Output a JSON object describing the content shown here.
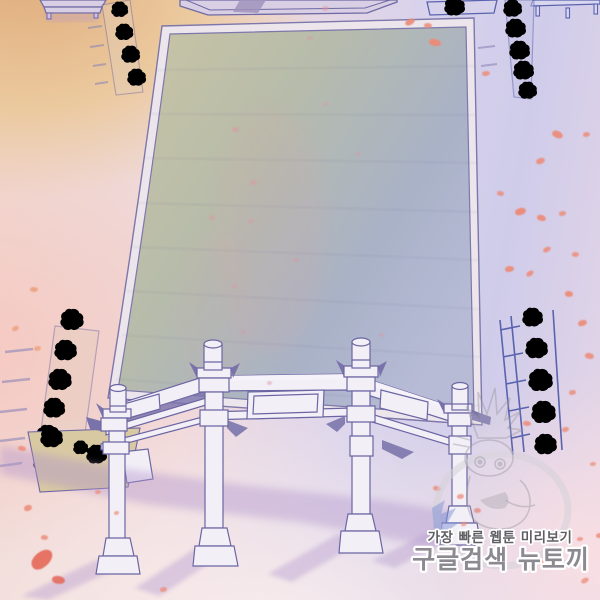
{
  "watermark": {
    "line1": "가장 빠른 웹툰 미리보기",
    "line2": "구글검색 뉴토끼",
    "line1_color": "#5f5e63",
    "line2_color": "#8c8a90",
    "outline_color": "#ffffff"
  },
  "palette": {
    "line": "#6b66a3",
    "salmon": "#ed8a76",
    "orange_petal": "#eb9d72",
    "red": "#e4604f",
    "faint_pink": "#d89aa4",
    "courtyard_khaki": "#cbc5a4",
    "courtyard_blue": "#b7bbd6",
    "ground_orange": "#e0ad7c",
    "ground_pink": "#f6c9c2",
    "ground_lavender": "#cfccea",
    "bush_green": "#a6a98e",
    "bush_blue": "#7f95d6",
    "shadow_purple": "#b094cc"
  },
  "petals": [
    [
      405,
      19,
      10,
      6,
      -20,
      "salmon",
      0.9
    ],
    [
      429,
      39,
      12,
      7,
      18,
      "salmon",
      0.95
    ],
    [
      482,
      71,
      8,
      5,
      0,
      "salmon",
      0.8
    ],
    [
      322,
      6,
      7,
      5,
      0,
      "faint_pink",
      0.55
    ],
    [
      424,
      23,
      8,
      5,
      10,
      "salmon",
      0.85
    ],
    [
      552,
      131,
      11,
      7,
      30,
      "salmon",
      0.9
    ],
    [
      583,
      132,
      7,
      5,
      0,
      "salmon",
      0.8
    ],
    [
      536,
      158,
      9,
      6,
      -15,
      "salmon",
      0.85
    ],
    [
      497,
      191,
      7,
      5,
      20,
      "salmon",
      0.8
    ],
    [
      515,
      208,
      11,
      7,
      -10,
      "salmon",
      0.95
    ],
    [
      537,
      215,
      9,
      6,
      25,
      "salmon",
      0.9
    ],
    [
      559,
      211,
      7,
      5,
      0,
      "salmon",
      0.8
    ],
    [
      543,
      247,
      8,
      5,
      -20,
      "salmon",
      0.85
    ],
    [
      572,
      252,
      7,
      5,
      10,
      "salmon",
      0.8
    ],
    [
      505,
      266,
      9,
      6,
      0,
      "salmon",
      0.9
    ],
    [
      526,
      271,
      8,
      5,
      -25,
      "salmon",
      0.85
    ],
    [
      565,
      291,
      8,
      6,
      15,
      "salmon",
      0.9
    ],
    [
      578,
      320,
      9,
      6,
      -10,
      "salmon",
      0.9
    ],
    [
      585,
      353,
      9,
      6,
      20,
      "salmon",
      0.85
    ],
    [
      569,
      390,
      7,
      5,
      0,
      "salmon",
      0.8
    ],
    [
      523,
      421,
      8,
      5,
      15,
      "salmon",
      0.85
    ],
    [
      562,
      427,
      7,
      5,
      -10,
      "salmon",
      0.8
    ],
    [
      590,
      462,
      6,
      4,
      0,
      "salmon",
      0.7
    ],
    [
      433,
      486,
      8,
      5,
      20,
      "salmon",
      0.8
    ],
    [
      457,
      494,
      7,
      5,
      0,
      "salmon",
      0.75
    ],
    [
      461,
      522,
      6,
      4,
      -15,
      "salmon",
      0.7
    ],
    [
      474,
      508,
      7,
      5,
      10,
      "red",
      0.6
    ],
    [
      540,
      560,
      9,
      6,
      10,
      "salmon",
      0.8
    ],
    [
      577,
      537,
      6,
      4,
      0,
      "salmon",
      0.75
    ],
    [
      596,
      533,
      7,
      5,
      0,
      "salmon",
      0.8
    ],
    [
      581,
      578,
      8,
      5,
      -20,
      "salmon",
      0.75
    ],
    [
      30,
      287,
      8,
      5,
      10,
      "orange_petal",
      0.8
    ],
    [
      12,
      326,
      7,
      5,
      -15,
      "orange_petal",
      0.75
    ],
    [
      34,
      346,
      7,
      5,
      0,
      "orange_petal",
      0.7
    ],
    [
      18,
      446,
      8,
      5,
      20,
      "salmon",
      0.8
    ],
    [
      24,
      505,
      8,
      6,
      -10,
      "salmon",
      0.85
    ],
    [
      41,
      535,
      7,
      5,
      15,
      "salmon",
      0.8
    ],
    [
      30,
      552,
      24,
      15,
      -35,
      "red",
      0.85
    ],
    [
      52,
      576,
      13,
      8,
      15,
      "red",
      0.8
    ],
    [
      95,
      490,
      6,
      4,
      0,
      "salmon",
      0.7
    ],
    [
      114,
      511,
      5,
      4,
      0,
      "salmon",
      0.7
    ],
    [
      160,
      587,
      7,
      5,
      0,
      "salmon",
      0.75
    ],
    [
      232,
      127,
      7,
      5,
      20,
      "faint_pink",
      0.6
    ],
    [
      250,
      180,
      7,
      5,
      -10,
      "faint_pink",
      0.55
    ],
    [
      209,
      215,
      6,
      5,
      0,
      "faint_pink",
      0.5
    ],
    [
      248,
      219,
      6,
      4,
      0,
      "faint_pink",
      0.5
    ],
    [
      293,
      258,
      6,
      4,
      15,
      "faint_pink",
      0.5
    ],
    [
      356,
      152,
      5,
      4,
      0,
      "faint_pink",
      0.45
    ],
    [
      323,
      102,
      5,
      4,
      0,
      "faint_pink",
      0.45
    ],
    [
      379,
      333,
      5,
      4,
      0,
      "faint_pink",
      0.45
    ],
    [
      232,
      284,
      5,
      4,
      0,
      "faint_pink",
      0.45
    ],
    [
      241,
      330,
      5,
      4,
      0,
      "faint_pink",
      0.45
    ],
    [
      267,
      381,
      5,
      4,
      10,
      "faint_pink",
      0.5
    ],
    [
      307,
      36,
      6,
      4,
      0,
      "faint_pink",
      0.5
    ]
  ]
}
